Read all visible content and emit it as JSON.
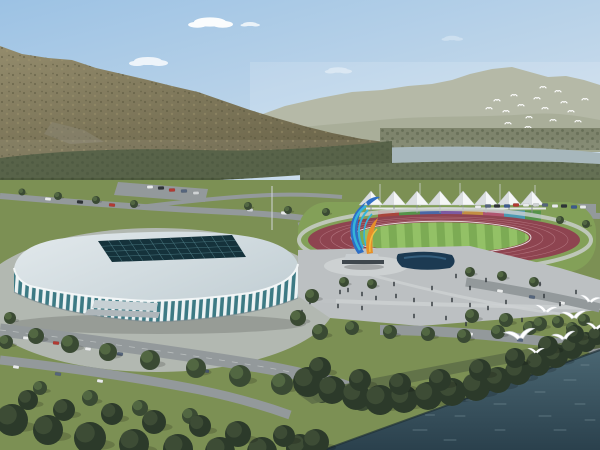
{
  "meta": {
    "title": "Sports complex aerial rendering",
    "description": "Architectural rendering: white ribbed indoor arena with teal glass and dark skylight grid, outdoor running-track stadium with white canopy tents and colorful grandstand panels, a blue-cyan-orange flame sculpture, plaza with pedestrians, tree-lined roads with cars, forested mountain behind, hazy far ridge with a flock of birds, a river strip, and a dark lake in the foreground with white gulls flying over shoreline trees."
  },
  "palette": {
    "sky_top": "#9cc2e4",
    "sky_mid": "#c3d8ea",
    "sky_low": "#e7edf1",
    "ridge_far": "#a9ae99",
    "ridge_near": "#9aa088",
    "mountain_hi": "#938b6c",
    "mountain_lo": "#6a6449",
    "mnt_speck_dark": "#55523a",
    "mnt_speck_light": "#a2976f",
    "veg_left": "#4e5a3e",
    "veg_speck": "#39442e",
    "veg_right": "#7e846c",
    "veg_right_dark": "#5c684a",
    "river": "#a2b3b8",
    "park_green": "#7c9054",
    "park_green_light": "#83a058",
    "road": "#93999b",
    "road_dash": "#c8cccc",
    "plaza": "#bcc0c2",
    "plaza_light": "#cdd1d2",
    "pool": "#1c3a52",
    "pool_light": "#3e6e90",
    "track": "#8e4450",
    "track_line": "#b87a84",
    "field_a": "#7cab54",
    "field_b": "#93c166",
    "fence": "#e5e8e9",
    "tent": "#f4f6f6",
    "tent_shade": "#c2c8cc",
    "tent_pole": "#8a9094",
    "arena_roof_light": "#e2e9ec",
    "arena_roof": "#c6d2d7",
    "arena_edge": "#f2f6f7",
    "skylight": "#15323b",
    "skylight_grid": "#4e7d86",
    "rib_white": "#edf3f4",
    "rib_glass": "#3d7a84",
    "sculpt_blue": "#2e6ec6",
    "sculpt_cyan": "#35b4da",
    "sculpt_orange": "#e68f2a",
    "sculpt_yellow": "#f0c040",
    "sculpt_base": "#3f474d",
    "tree_dark": "#3a4a33",
    "tree_light": "#5d7348",
    "shore_tree": "#2c3a2a",
    "shore_tree_hi": "#44543a",
    "shore_grass": "#5f7048",
    "water_top": "#4a6672",
    "water_bottom": "#2a404c",
    "water_sparkle": "#7b949c",
    "bird_white": "#ffffff",
    "bird_shade": "#c9ced2",
    "people": "#2e3338",
    "car_colors": [
      "#e9ebeb",
      "#2e3336",
      "#b23a32",
      "#55657c",
      "#cfd3d4",
      "#3c5a8c"
    ]
  },
  "scene": {
    "clouds": [
      {
        "x": 148,
        "y": 61,
        "s": 1.0,
        "o": 0.8
      },
      {
        "x": 210,
        "y": 22,
        "s": 1.15,
        "o": 0.95
      },
      {
        "x": 250,
        "y": 24,
        "s": 0.5,
        "o": 0.75
      },
      {
        "x": 338,
        "y": 70,
        "s": 0.7,
        "o": 0.4
      },
      {
        "x": 452,
        "y": 38,
        "s": 0.55,
        "o": 0.3
      }
    ],
    "far_birds": [
      [
        489,
        108
      ],
      [
        497,
        100
      ],
      [
        506,
        111
      ],
      [
        514,
        95
      ],
      [
        521,
        105
      ],
      [
        529,
        117
      ],
      [
        537,
        98
      ],
      [
        545,
        108
      ],
      [
        553,
        120
      ],
      [
        558,
        91
      ],
      [
        564,
        102
      ],
      [
        571,
        111
      ],
      [
        578,
        121
      ],
      [
        585,
        99
      ],
      [
        508,
        123
      ],
      [
        528,
        127
      ],
      [
        550,
        129
      ],
      [
        543,
        87
      ]
    ],
    "gulls": [
      {
        "x": 520,
        "y": 337,
        "s": 1.4,
        "r": -8
      },
      {
        "x": 546,
        "y": 311,
        "s": 1.05,
        "r": 6
      },
      {
        "x": 574,
        "y": 317,
        "s": 1.15,
        "r": -4
      },
      {
        "x": 590,
        "y": 301,
        "s": 0.95,
        "r": 8
      },
      {
        "x": 564,
        "y": 338,
        "s": 1.05,
        "r": -10
      },
      {
        "x": 596,
        "y": 328,
        "s": 0.9,
        "r": 4
      },
      {
        "x": 536,
        "y": 352,
        "s": 0.75,
        "r": 0
      }
    ],
    "tents": {
      "x0": 371,
      "step": 23,
      "count": 8,
      "apex_y": 191,
      "base_y": 205,
      "half": 12,
      "pole_y": 213
    },
    "panels": [
      {
        "x": 378,
        "w": 21,
        "c": "#a8453c"
      },
      {
        "x": 399,
        "w": 21,
        "c": "#55934a"
      },
      {
        "x": 420,
        "w": 21,
        "c": "#4a67a6"
      },
      {
        "x": 441,
        "w": 21,
        "c": "#7c59a2"
      },
      {
        "x": 462,
        "w": 21,
        "c": "#c38f42"
      },
      {
        "x": 483,
        "w": 21,
        "c": "#b05570"
      },
      {
        "x": 504,
        "w": 21,
        "c": "#4c9ab2"
      },
      {
        "x": 525,
        "w": 16,
        "c": "#55934a"
      }
    ],
    "skylight": {
      "corners": [
        [
          98,
          241
        ],
        [
          232,
          235
        ],
        [
          246,
          257
        ],
        [
          112,
          262
        ]
      ],
      "cols": 13,
      "rows": 4
    },
    "park_trees": [
      [
        22,
        192,
        3.5
      ],
      [
        58,
        196,
        4
      ],
      [
        96,
        200,
        4
      ],
      [
        134,
        204,
        4
      ],
      [
        248,
        206,
        4
      ],
      [
        288,
        210,
        4
      ],
      [
        326,
        212,
        4
      ],
      [
        560,
        220,
        4
      ],
      [
        586,
        224,
        4
      ],
      [
        312,
        296,
        7
      ],
      [
        298,
        318,
        8
      ],
      [
        320,
        332,
        8
      ],
      [
        352,
        328,
        7
      ],
      [
        390,
        332,
        7
      ],
      [
        428,
        334,
        7
      ],
      [
        464,
        336,
        7
      ],
      [
        498,
        332,
        7
      ],
      [
        530,
        328,
        7
      ],
      [
        558,
        322,
        6
      ],
      [
        584,
        320,
        6
      ],
      [
        344,
        282,
        5
      ],
      [
        372,
        284,
        5
      ],
      [
        470,
        272,
        5
      ],
      [
        502,
        276,
        5
      ],
      [
        534,
        282,
        5
      ],
      [
        472,
        316,
        7
      ],
      [
        506,
        320,
        7
      ],
      [
        540,
        324,
        7
      ],
      [
        572,
        328,
        6
      ],
      [
        36,
        336,
        8
      ],
      [
        70,
        344,
        9
      ],
      [
        108,
        352,
        9
      ],
      [
        150,
        360,
        10
      ],
      [
        196,
        368,
        10
      ],
      [
        240,
        376,
        11
      ],
      [
        282,
        384,
        11
      ],
      [
        322,
        392,
        11
      ],
      [
        362,
        400,
        11
      ],
      [
        10,
        318,
        6
      ],
      [
        6,
        342,
        7
      ],
      [
        40,
        388,
        7
      ],
      [
        90,
        398,
        8
      ],
      [
        140,
        408,
        8
      ],
      [
        190,
        416,
        8
      ]
    ],
    "shore_trees": [
      [
        308,
        382,
        15
      ],
      [
        332,
        390,
        14
      ],
      [
        356,
        396,
        14
      ],
      [
        380,
        400,
        15
      ],
      [
        404,
        399,
        14
      ],
      [
        428,
        396,
        14
      ],
      [
        452,
        392,
        14
      ],
      [
        476,
        387,
        14
      ],
      [
        498,
        380,
        13
      ],
      [
        518,
        372,
        13
      ],
      [
        538,
        364,
        12
      ],
      [
        556,
        356,
        12
      ],
      [
        572,
        348,
        11
      ],
      [
        586,
        342,
        10
      ],
      [
        597,
        336,
        9
      ],
      [
        320,
        368,
        11
      ],
      [
        360,
        380,
        11
      ],
      [
        400,
        384,
        11
      ],
      [
        440,
        380,
        11
      ],
      [
        480,
        370,
        11
      ],
      [
        515,
        358,
        10
      ],
      [
        548,
        346,
        10
      ],
      [
        575,
        334,
        9
      ]
    ],
    "bottom_trees": [
      [
        12,
        420,
        16
      ],
      [
        48,
        430,
        15
      ],
      [
        90,
        438,
        16
      ],
      [
        134,
        444,
        15
      ],
      [
        178,
        449,
        15
      ],
      [
        220,
        452,
        15
      ],
      [
        262,
        452,
        15
      ],
      [
        300,
        448,
        14
      ],
      [
        64,
        410,
        11
      ],
      [
        154,
        422,
        12
      ],
      [
        238,
        434,
        13
      ],
      [
        316,
        442,
        13
      ],
      [
        28,
        400,
        10
      ],
      [
        112,
        414,
        11
      ],
      [
        200,
        426,
        11
      ],
      [
        284,
        436,
        11
      ]
    ],
    "cars": [
      [
        150,
        187,
        0,
        -2
      ],
      [
        161,
        188,
        1,
        -2
      ],
      [
        172,
        190,
        2,
        -2
      ],
      [
        184,
        191,
        3,
        -2
      ],
      [
        196,
        193,
        4,
        -2
      ],
      [
        48,
        199,
        0,
        5
      ],
      [
        80,
        202,
        1,
        5
      ],
      [
        112,
        205,
        2,
        5
      ],
      [
        250,
        210,
        4,
        3
      ],
      [
        284,
        213,
        0,
        3
      ],
      [
        478,
        207,
        0,
        0
      ],
      [
        488,
        206,
        3,
        0
      ],
      [
        497,
        206,
        1,
        0
      ],
      [
        507,
        206,
        5,
        0
      ],
      [
        516,
        205,
        2,
        0
      ],
      [
        526,
        205,
        0,
        0
      ],
      [
        536,
        205,
        4,
        0
      ],
      [
        545,
        205,
        3,
        0
      ],
      [
        555,
        206,
        0,
        0
      ],
      [
        564,
        206,
        1,
        0
      ],
      [
        574,
        207,
        5,
        0
      ],
      [
        583,
        207,
        0,
        0
      ],
      [
        26,
        338,
        0,
        6
      ],
      [
        56,
        343,
        2,
        6
      ],
      [
        88,
        349,
        0,
        7
      ],
      [
        120,
        354,
        3,
        7
      ],
      [
        154,
        360,
        1,
        8
      ],
      [
        16,
        367,
        0,
        8
      ],
      [
        58,
        374,
        3,
        9
      ],
      [
        100,
        381,
        0,
        9
      ],
      [
        206,
        371,
        3,
        8
      ],
      [
        246,
        378,
        0,
        8
      ],
      [
        500,
        291,
        0,
        8
      ],
      [
        532,
        297,
        3,
        9
      ],
      [
        562,
        303,
        0,
        10
      ],
      [
        470,
        334,
        0,
        5
      ],
      [
        520,
        340,
        3,
        6
      ],
      [
        560,
        346,
        0,
        6
      ]
    ],
    "people": [
      [
        348,
        290
      ],
      [
        362,
        294
      ],
      [
        376,
        298
      ],
      [
        396,
        296
      ],
      [
        414,
        300
      ],
      [
        432,
        304
      ],
      [
        452,
        300
      ],
      [
        470,
        305
      ],
      [
        488,
        308
      ],
      [
        506,
        302
      ],
      [
        470,
        288
      ],
      [
        432,
        288
      ],
      [
        394,
        284
      ],
      [
        362,
        308
      ],
      [
        338,
        306
      ],
      [
        544,
        296
      ],
      [
        560,
        304
      ],
      [
        576,
        292
      ],
      [
        446,
        318
      ],
      [
        466,
        324
      ],
      [
        414,
        316
      ],
      [
        340,
        292
      ],
      [
        540,
        284
      ],
      [
        522,
        320
      ],
      [
        580,
        318
      ],
      [
        310,
        302
      ],
      [
        302,
        312
      ],
      [
        486,
        280
      ],
      [
        456,
        276
      ]
    ],
    "sparkles": [
      [
        420,
        430,
        14
      ],
      [
        460,
        416,
        10
      ],
      [
        500,
        404,
        12
      ],
      [
        540,
        392,
        10
      ],
      [
        570,
        380,
        12
      ],
      [
        450,
        440,
        12
      ],
      [
        500,
        430,
        10
      ],
      [
        545,
        416,
        12
      ],
      [
        580,
        404,
        10
      ],
      [
        560,
        430,
        12
      ],
      [
        590,
        420,
        10
      ],
      [
        470,
        400,
        8
      ],
      [
        430,
        415,
        9
      ],
      [
        585,
        365,
        8
      ],
      [
        525,
        378,
        10
      ]
    ]
  }
}
